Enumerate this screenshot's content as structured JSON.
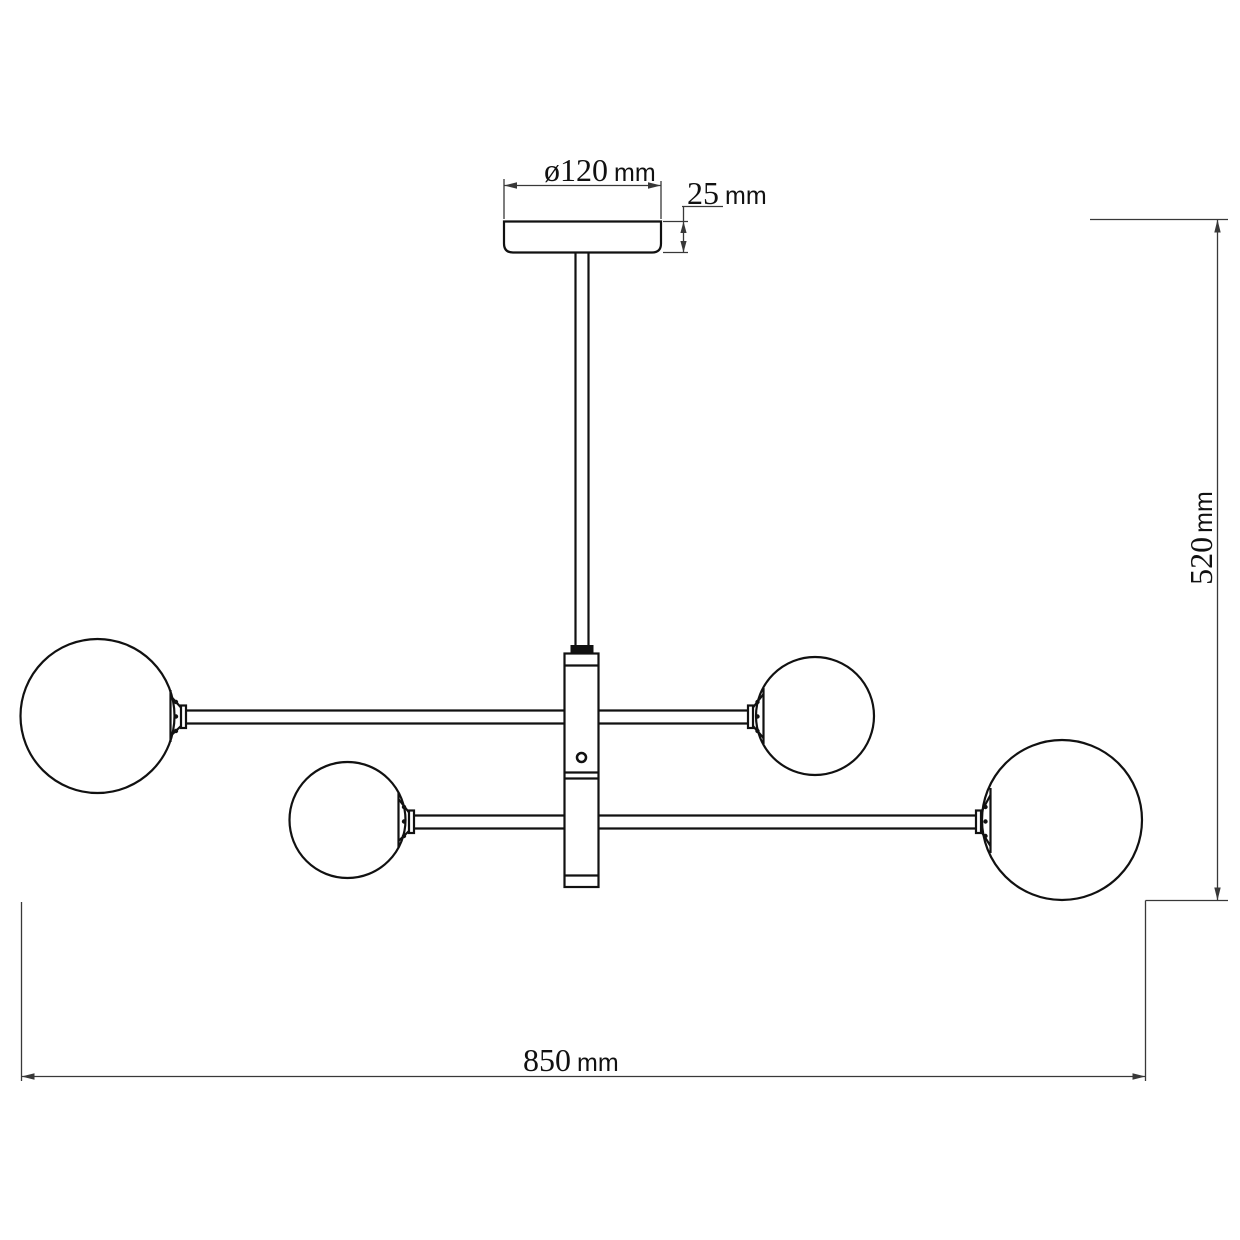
{
  "dimensions": {
    "canopy_diameter": {
      "value": "ø120",
      "unit": "mm"
    },
    "canopy_height": {
      "value": "25",
      "unit": "mm"
    },
    "overall_height": {
      "value": "520",
      "unit": "mm"
    },
    "overall_width": {
      "value": "850",
      "unit": "mm"
    }
  },
  "colors": {
    "outline": "#111111",
    "dimension": "#383838",
    "background": "#ffffff"
  }
}
